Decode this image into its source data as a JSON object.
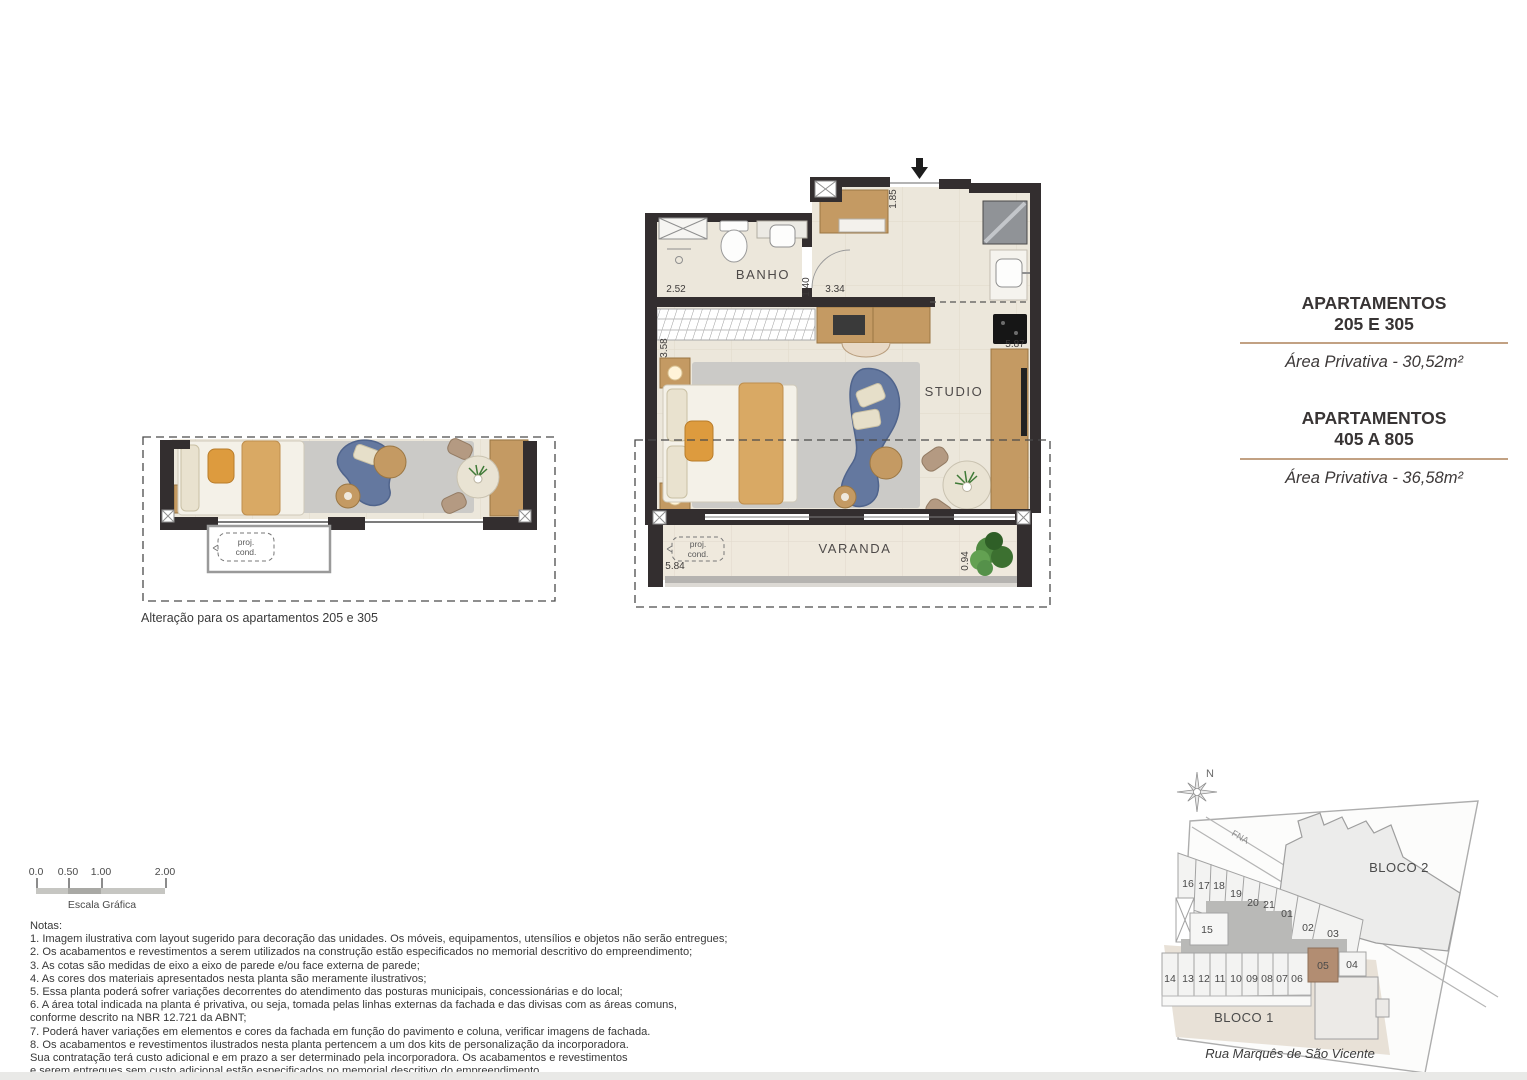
{
  "info_panel": {
    "groups": [
      {
        "title": "APARTAMENTOS",
        "subtitle": "205 E 305",
        "area": "Área Privativa - 30,52m²"
      },
      {
        "title": "APARTAMENTOS",
        "subtitle": "405 A 805",
        "area": "Área Privativa - 36,58m²"
      }
    ]
  },
  "main_plan": {
    "room_bathroom": "BANHO",
    "room_studio": "STUDIO",
    "room_balcony": "VARANDA",
    "proj_line1": "proj.",
    "proj_line2": "cond.",
    "dim_bath_width": "2.52",
    "dim_bath_door": "1.40",
    "dim_corridor_wall": "3.34",
    "dim_entry": "1.85",
    "dim_closet_side": "3.58",
    "dim_kitchen_run": "5.87",
    "dim_balcony_width": "5.84",
    "dim_balcony_depth": "0.94"
  },
  "variant_plan": {
    "proj_line1": "proj.",
    "proj_line2": "cond.",
    "caption": "Alteração para os apartamentos 205 e 305"
  },
  "site_plan": {
    "north": "N",
    "road": "FNA",
    "bloco1": "BLOCO 1",
    "bloco2": "BLOCO 2",
    "street": "Rua Marquês de São Vicente",
    "units_top": [
      "16",
      "17",
      "18",
      "19",
      "20",
      "21",
      "01",
      "02",
      "03"
    ],
    "unit15": "15",
    "units_bottom": [
      "14",
      "13",
      "12",
      "11",
      "10",
      "09",
      "08",
      "07",
      "06"
    ],
    "unit05": "05",
    "unit04": "04",
    "highlight_color": "#b28d72"
  },
  "scale_bar": {
    "labels": [
      "0.0",
      "0.50",
      "1.00",
      "2.00"
    ],
    "caption": "Escala Gráfica"
  },
  "notes": {
    "title": "Notas:",
    "items": [
      "1. Imagem ilustrativa com layout sugerido para decoração das unidades. Os móveis, equipamentos, utensílios e objetos não serão entregues;",
      "2. Os acabamentos e revestimentos a serem utilizados na construção estão especificados no memorial descritivo do empreendimento;",
      "3. As cotas são medidas de eixo a eixo de parede e/ou face externa de parede;",
      "4. As cores dos materiais apresentados nesta planta são meramente ilustrativos;",
      "5. Essa planta poderá sofrer variações decorrentes do atendimento das posturas municipais, concessionárias e do local;",
      "6. A área total indicada na planta é privativa, ou seja, tomada pelas linhas externas da fachada e das divisas com as áreas comuns,\n    conforme descrito na NBR 12.721 da ABNT;",
      "7. Poderá haver variações em elementos e cores da fachada em função do pavimento e coluna, verificar imagens de fachada.",
      "8. Os acabamentos e revestimentos ilustrados nesta planta pertencem a um dos kits de personalização da incorporadora.\n    Sua contratação terá custo adicional e em prazo a ser determinado pela incorporadora. Os acabamentos e revestimentos\n    e serem entregues sem custo adicional estão especificados  no memorial descritivo do empreendimento."
    ]
  },
  "colors": {
    "wall": "#332e2f",
    "wood": "#c49a63",
    "sofa": "#64789f",
    "divider": "#c2a183",
    "highlight_unit": "#b28d72"
  }
}
